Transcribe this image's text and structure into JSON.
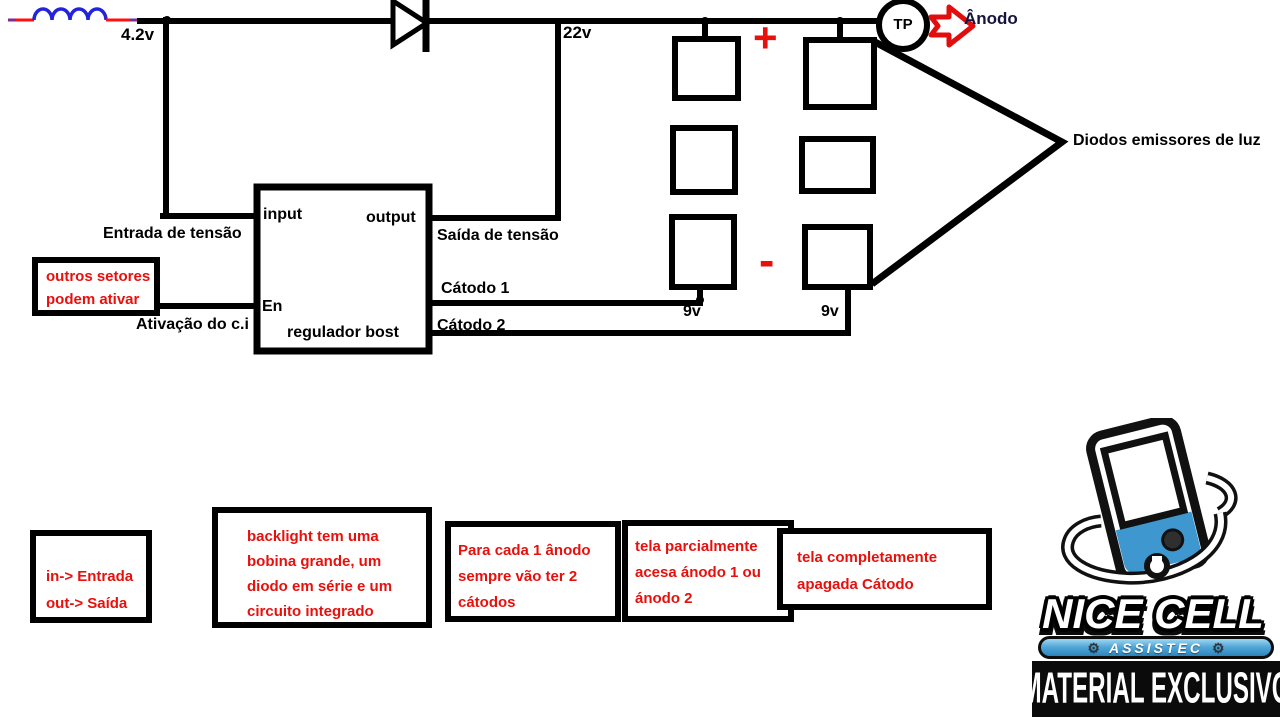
{
  "circuit": {
    "labels": {
      "vin": "4.2v",
      "vout": "22v",
      "input": "input",
      "output": "output",
      "enable": "En",
      "regulator_name": "regulador bost",
      "entrada": "Entrada de tensão",
      "saida": "Saída de tensão",
      "catodo1": "Cátodo 1",
      "catodo2": "Cátodo 2",
      "ativacao": "Ativação do c.i",
      "plus": "+",
      "minus": "-",
      "v9_left": "9v",
      "v9_right": "9v",
      "tp": "TP",
      "anodo": "Ânodo",
      "leds": "Diodos emissores de luz"
    },
    "callout": {
      "line1": "outros setores",
      "line2": "podem ativar"
    },
    "colors": {
      "wire_black": "#000000",
      "wire_red": "#ff1111",
      "coil_blue": "#2323dd",
      "lead_purple": "#7b2e8d",
      "annotation_red": "#e8100c",
      "arrow_red": "#e20d0d"
    }
  },
  "notes": {
    "n1": {
      "l1": "in-> Entrada",
      "l2": "out-> Saída"
    },
    "n2": {
      "l1": "backlight tem uma",
      "l2": "bobina grande, um",
      "l3": "diodo em série e um",
      "l4": "circuito integrado"
    },
    "n3": {
      "l1": "Para cada 1 ânodo",
      "l2": "sempre vão ter 2",
      "l3": "cátodos"
    },
    "n4": {
      "l1": "tela parcialmente",
      "l2": "acesa ánodo 1 ou",
      "l3": "ánodo 2"
    },
    "n5": {
      "l1": "tela completamente",
      "l2": "apagada Cátodo"
    }
  },
  "logo": {
    "title": "NICE CELL",
    "badge": "ASSISTEC",
    "banner": "MATERIAL EXCLUSIVO",
    "gear": "⚙",
    "brand_blue": "#3e97cf"
  }
}
